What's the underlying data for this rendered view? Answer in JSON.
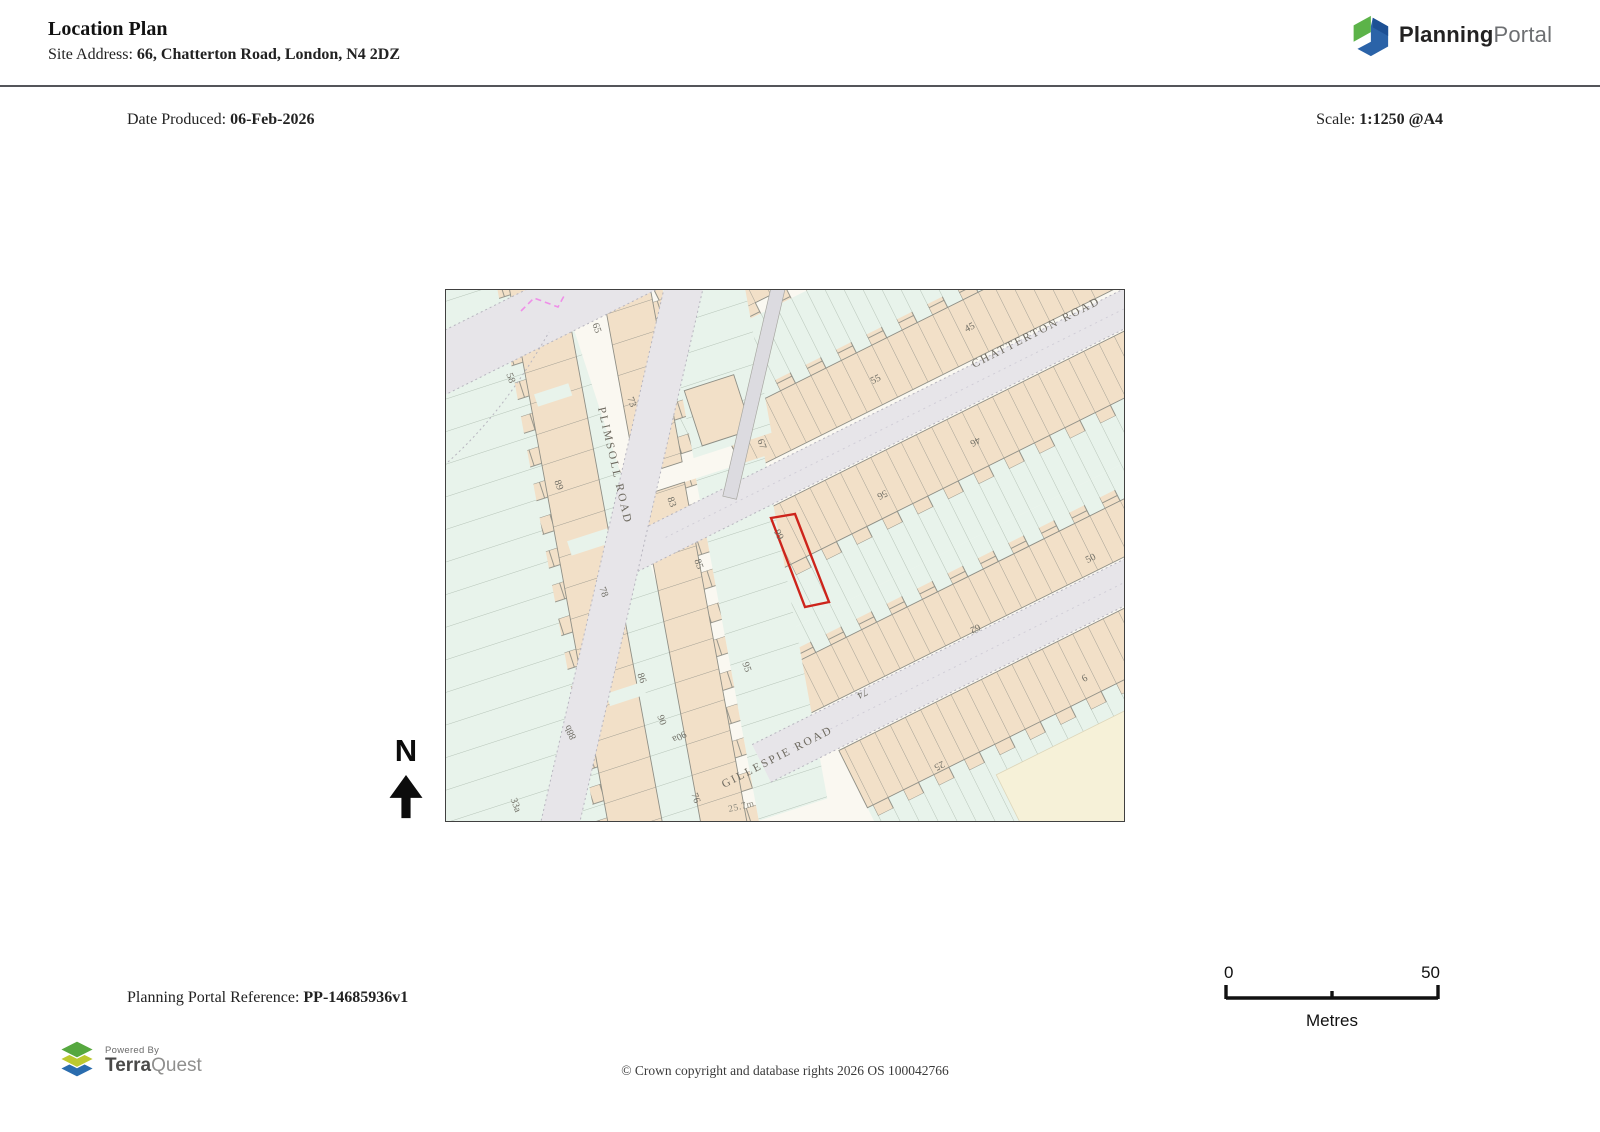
{
  "header": {
    "title": "Location Plan",
    "site_address_label": "Site Address:",
    "site_address": "66, Chatterton Road, London, N4 2DZ"
  },
  "logo": {
    "brand_bold": "Planning",
    "brand_light": "Portal"
  },
  "meta": {
    "date_label": "Date Produced:",
    "date_value": "06-Feb-2026",
    "scale_label": "Scale:",
    "scale_value": "1:1250 @A4"
  },
  "map": {
    "north_label": "N",
    "spot_height": "25.7m",
    "site_color": "#cd241b",
    "streets": [
      {
        "name": "PLIMSOLL ROAD"
      },
      {
        "name": "CHATTERTON ROAD"
      },
      {
        "name": "GILLESPIE ROAD"
      }
    ],
    "house_numbers": [
      {
        "text": "58"
      },
      {
        "text": "65"
      },
      {
        "text": "73"
      },
      {
        "text": "83"
      },
      {
        "text": "89"
      },
      {
        "text": "67"
      },
      {
        "text": "78"
      },
      {
        "text": "86"
      },
      {
        "text": "88b"
      },
      {
        "text": "90"
      },
      {
        "text": "90a"
      },
      {
        "text": "33a"
      },
      {
        "text": "76"
      },
      {
        "text": "85"
      },
      {
        "text": "95"
      },
      {
        "text": "45"
      },
      {
        "text": "55"
      },
      {
        "text": "46"
      },
      {
        "text": "56"
      },
      {
        "text": "66"
      },
      {
        "text": "50"
      },
      {
        "text": "62"
      },
      {
        "text": "74"
      },
      {
        "text": "25"
      },
      {
        "text": "6"
      }
    ]
  },
  "scalebar": {
    "start": "0",
    "end": "50",
    "unit": "Metres"
  },
  "footer": {
    "reference_label": "Planning Portal Reference:",
    "reference_value": "PP-14685936v1",
    "powered_by": "Powered By",
    "brand_bold": "Terra",
    "brand_light": "Quest",
    "copyright": "© Crown copyright and database rights 2026 OS 100042766"
  }
}
